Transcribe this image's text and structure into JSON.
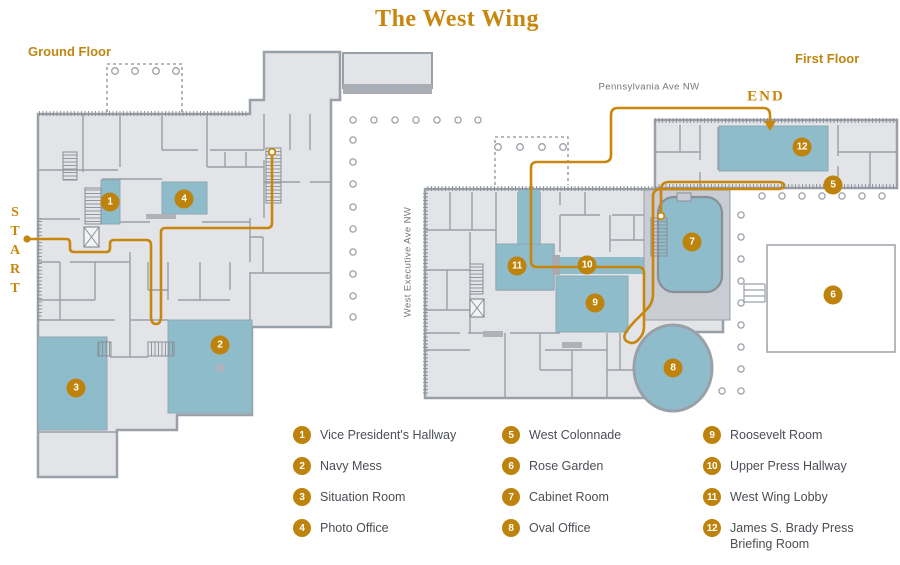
{
  "title": "The West Wing",
  "floors": {
    "ground": "Ground Floor",
    "first": "First Floor"
  },
  "route": {
    "start": "START",
    "end": "END"
  },
  "streets": {
    "pennsylvania": "Pennsylvania Ave NW",
    "west_executive": "West Executive Ave NW"
  },
  "colors": {
    "gold": "#C8860D",
    "marker_gold": "#BE830D",
    "room_blue": "#8FBCCB",
    "floor_fill": "#E2E4E8",
    "wall_gray": "#9AA0A7",
    "legend_text": "#4B4E54",
    "street_text": "#70757C"
  },
  "markers": {
    "ground": [
      {
        "n": "1",
        "x": 110,
        "y": 202
      },
      {
        "n": "2",
        "x": 220,
        "y": 345
      },
      {
        "n": "3",
        "x": 76,
        "y": 388
      },
      {
        "n": "4",
        "x": 184,
        "y": 199
      }
    ],
    "first": [
      {
        "n": "5",
        "x": 833,
        "y": 185
      },
      {
        "n": "6",
        "x": 833,
        "y": 295
      },
      {
        "n": "7",
        "x": 692,
        "y": 242
      },
      {
        "n": "8",
        "x": 673,
        "y": 368
      },
      {
        "n": "9",
        "x": 595,
        "y": 303
      },
      {
        "n": "10",
        "x": 587,
        "y": 265
      },
      {
        "n": "11",
        "x": 517,
        "y": 266
      },
      {
        "n": "12",
        "x": 802,
        "y": 147
      }
    ]
  },
  "legend": {
    "columns": [
      {
        "items": [
          {
            "n": "1",
            "label": "Vice President's Hallway"
          },
          {
            "n": "2",
            "label": "Navy Mess"
          },
          {
            "n": "3",
            "label": "Situation Room"
          },
          {
            "n": "4",
            "label": "Photo Office"
          }
        ]
      },
      {
        "items": [
          {
            "n": "5",
            "label": "West Colonnade"
          },
          {
            "n": "6",
            "label": "Rose Garden"
          },
          {
            "n": "7",
            "label": "Cabinet Room"
          },
          {
            "n": "8",
            "label": "Oval Office"
          }
        ]
      },
      {
        "items": [
          {
            "n": "9",
            "label": "Roosevelt Room"
          },
          {
            "n": "10",
            "label": "Upper Press Hallway"
          },
          {
            "n": "11",
            "label": "West Wing Lobby"
          },
          {
            "n": "12",
            "label": "James S. Brady Press Briefing Room"
          }
        ]
      }
    ]
  }
}
